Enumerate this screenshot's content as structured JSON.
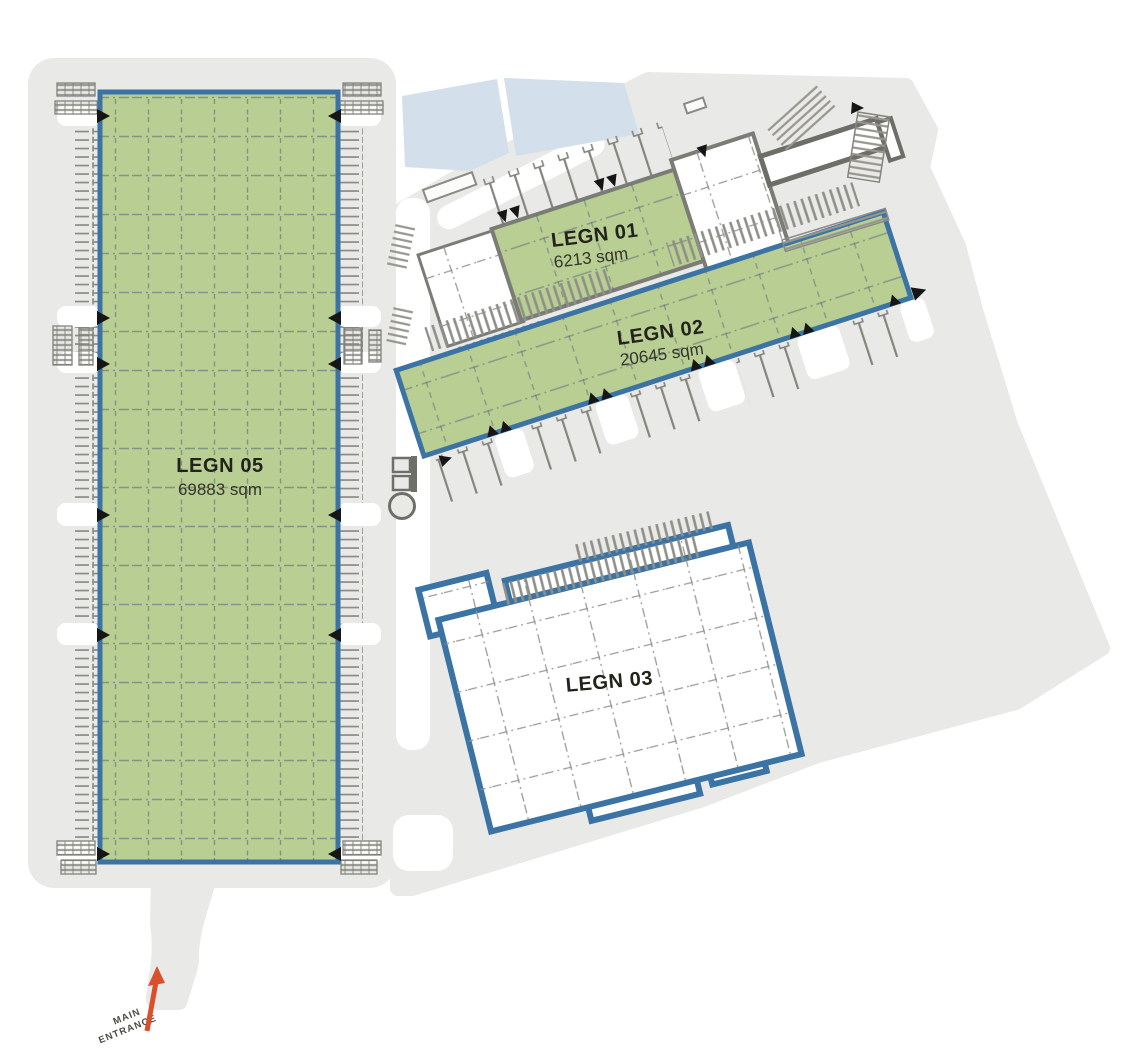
{
  "colors": {
    "ground": "#e9e9e7",
    "road": "#ffffff",
    "pond": "#d3dfeb",
    "green": "#b8ce92",
    "blue": "#3b74a4",
    "grayline": "#7c7c77",
    "marker": "#161616",
    "arrow": "#d9502a",
    "text": "#23231c",
    "subtext": "#35352c"
  },
  "buildings": [
    {
      "id": "legn-05",
      "name": "LEGN 05",
      "area": "69883 sqm",
      "fill_style": "green",
      "outline": "blue"
    },
    {
      "id": "legn-01",
      "name": "LEGN 01",
      "area": "6213 sqm",
      "fill_style": "green",
      "outline": "gray"
    },
    {
      "id": "legn-02",
      "name": "LEGN 02",
      "area": "20645 sqm",
      "fill_style": "green",
      "outline": "blue"
    },
    {
      "id": "legn-03",
      "name": "LEGN 03",
      "fill_style": "white",
      "outline": "blue"
    }
  ],
  "entrance": {
    "line1": "MAIN",
    "line2": "ENTRANCE"
  },
  "icons": {
    "dock_marker": "dock-arrow-icon",
    "water_tank": "water-tank-icon",
    "entrance_arrow": "entrance-arrow-icon"
  }
}
